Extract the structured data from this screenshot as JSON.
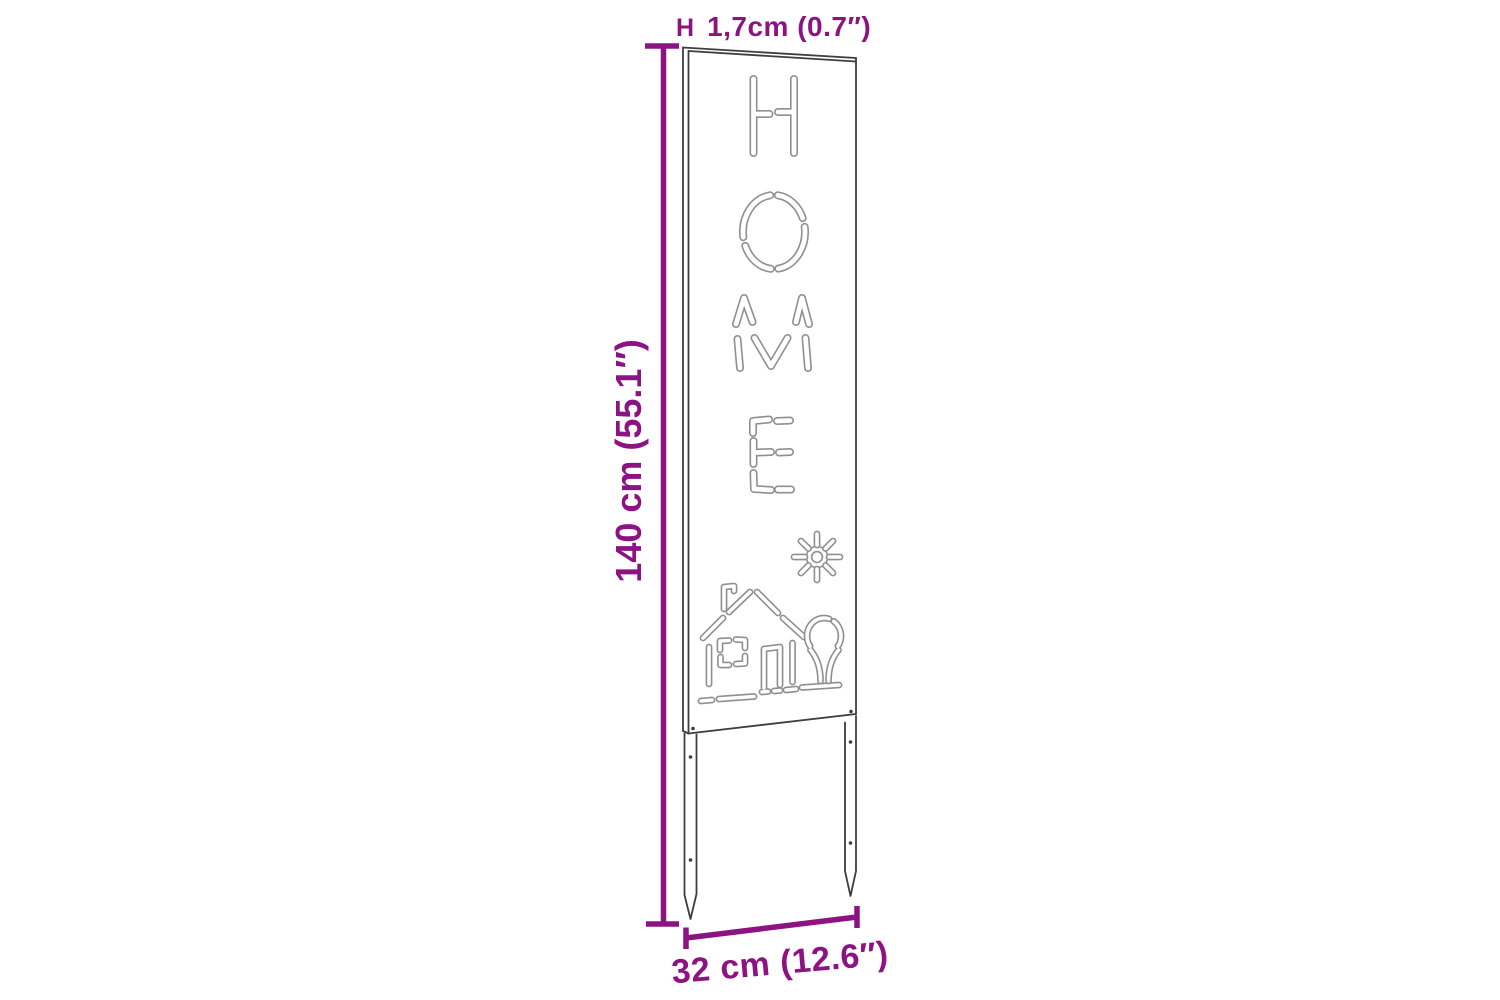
{
  "diagram": {
    "kind": "product-dimension-diagram",
    "cutout_word": "HOME",
    "cutout_icons": [
      "sun",
      "house",
      "tree"
    ],
    "dimensions": {
      "height": "140 cm (55.1″)",
      "thickness_marker": "H",
      "thickness": "1,7cm (0.7″)",
      "width": "32 cm (12.6″)"
    },
    "colors": {
      "dimension-annotation": "#8E1382",
      "panel-outline": "#3E3E3E",
      "cutout-outline": "#8F8F8F",
      "background": "#FFFFFF"
    }
  }
}
